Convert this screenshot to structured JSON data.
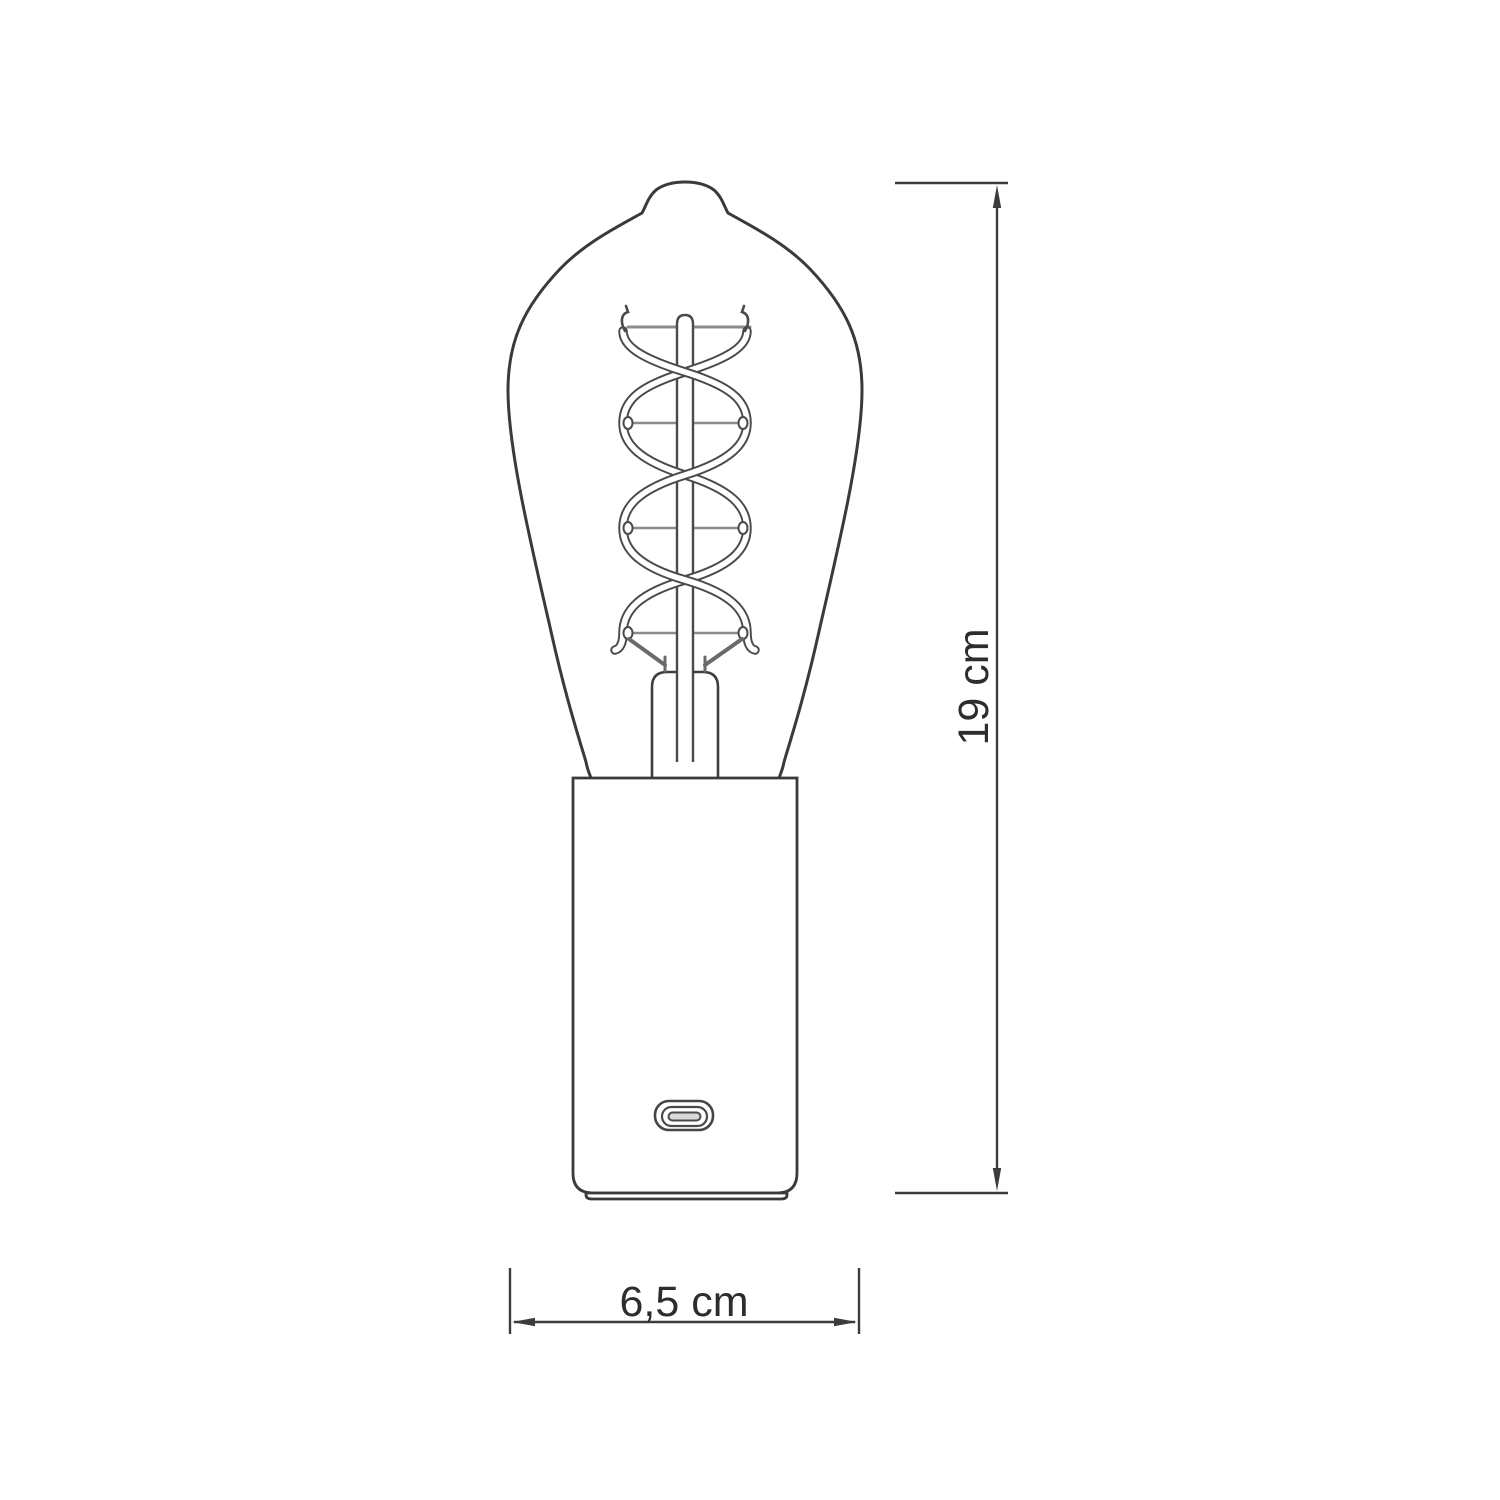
{
  "diagram": {
    "title": "bulb-table-lamp-dimension-drawing",
    "dimensions": {
      "height": {
        "label": "19 cm",
        "value": 19,
        "unit": "cm",
        "orientation": "vertical"
      },
      "width": {
        "label": "6,5 cm",
        "value": 6.5,
        "unit": "cm",
        "orientation": "horizontal"
      }
    },
    "colors": {
      "background": "#ffffff",
      "outline": "#3a3a3b",
      "support_bar": "#8b8b8c",
      "support_wire": "#6a6a6b",
      "dimension_line": "#3c3c3d",
      "label_text": "#2d2d2f",
      "usb_tongue": "#d9d9da"
    }
  }
}
